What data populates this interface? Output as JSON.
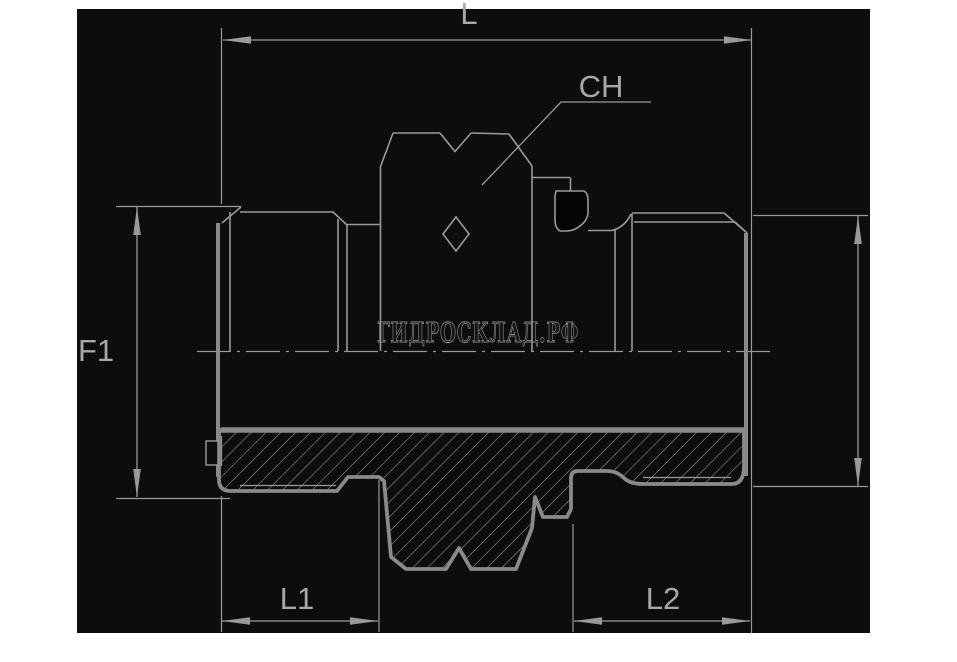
{
  "title": "Adapter fitting technical drawing",
  "panel": {
    "page_background": "#ffffff",
    "background": "#0d0d0d",
    "thin_line_color": "#9a9a9a",
    "thick_line_color": "#8a8a8a",
    "label_color": "#a8a8a8"
  },
  "dimensions": {
    "overall_length_label": "L",
    "hex_wrench_label": "CH",
    "left_thread_label": "F1",
    "left_length_label": "L1",
    "right_length_label": "L2"
  },
  "watermark": {
    "text": "ГИДРОСКЛАД.РФ",
    "color": "#858585"
  }
}
